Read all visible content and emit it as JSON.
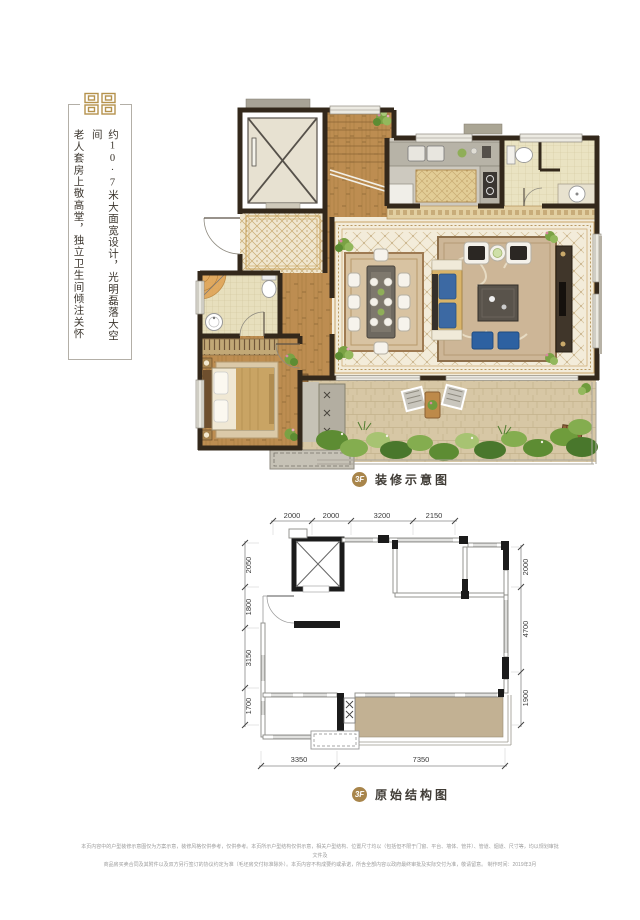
{
  "tagline": {
    "line1": "约10·7米大面宽设计，光明磊落大空间",
    "line2": "老人套房上敬高堂，独立卫生间倾注关怀"
  },
  "decorated_plan": {
    "badge": "3F",
    "title": "装修示意图"
  },
  "structural_plan": {
    "badge": "3F",
    "title": "原始结构图",
    "dimensions": {
      "top": [
        "2000",
        "2000",
        "3200",
        "2150"
      ],
      "left": [
        "2050",
        "1800",
        "3150",
        "1700"
      ],
      "right": [
        "2000",
        "4700",
        "1900"
      ],
      "bottom": [
        "3350",
        "7350"
      ]
    }
  },
  "footer": {
    "line1": "本页内容中的户型装修示意图仅为方案示意，装修风格仅供参考，仅供参考。本页所示户型结构仅供示意，相关户型结构、位置尺寸均以（包括但不限于门窗、平台、墙体、管井）、管道、烟道、尺寸等，均以规划审批文件及",
    "line2": "商品房买卖合同及其附件以及双方另行签订的协议约定为准（毛坯房交付标准除外）。本页内容不构成要约或承诺，所含全部内容以政府最终审批及实际交付为准，敬请留意。  制作时间：2019年3月"
  },
  "colors": {
    "gold": "#a8854b",
    "wall": "#33281b",
    "terrace_fill": "#c2b193",
    "wood": "#bd8d51"
  }
}
